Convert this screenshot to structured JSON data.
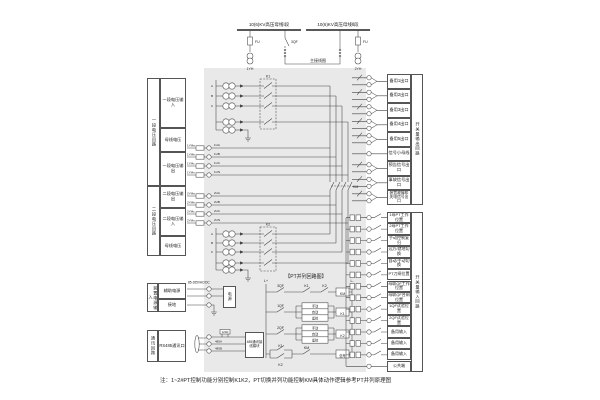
{
  "main_wiring": {
    "bus1": "10(6)KV高压母线Ⅰ段",
    "bus2": "10(6)KV高压母线Ⅱ段",
    "fu": "FU",
    "qf": "3QF",
    "pt1": "1YH",
    "pt2": "2YH",
    "caption": "主接线图"
  },
  "left": {
    "g1": {
      "v": "一段电压回路",
      "c1": "一段电压输入",
      "c2": "母线电压",
      "c3": "一段电压输出"
    },
    "g2": {
      "v": "二段电压回路",
      "c1": "二段电压输出",
      "c2": "二段电压输入",
      "c3": "母线电压"
    },
    "g3": {
      "v": "装置电源输入",
      "c1": "辅助电源",
      "c2": "接地"
    },
    "g4": {
      "v": "通讯回路",
      "c1": "RS485通讯口"
    }
  },
  "mid": {
    "title": "【PT并列回路图】",
    "k1": "K1",
    "k2": "K2",
    "km": "KM",
    "phases": [
      "A",
      "B",
      "C"
    ],
    "s1tags": [
      "1YMa",
      "1YMb",
      "1YMc",
      "1YMn"
    ],
    "s1terms": [
      "1UA",
      "1UB",
      "1UC",
      "1UN"
    ],
    "s2tags": [
      "2YMa",
      "2YMb",
      "2YMc",
      "2YMn"
    ],
    "s2terms": [
      "2UA",
      "2UB",
      "2UC",
      "2UN"
    ],
    "power": {
      "range": "85-265VAC/DC",
      "box": "电源"
    },
    "comm": {
      "box": "485通讯接线模块",
      "a": "485A",
      "b": "485B",
      "res": "120Ω"
    },
    "ladder": {
      "lp": "L+",
      "lm": "L-",
      "r1": {
        "a": "3QF",
        "b": "K1",
        "c": "K2",
        "coil": "KM"
      },
      "r2": {
        "a": "1QF",
        "s1": "手动",
        "s2": "自动",
        "s3": "遥控",
        "coil": "K1"
      },
      "r3": {
        "a": "2QF",
        "s1": "手动",
        "s2": "自动",
        "s3": "遥控",
        "coil": "K2"
      },
      "r4": {
        "a": "K1",
        "b": "K2",
        "c": "KM",
        "coil": "信号"
      }
    }
  },
  "outputs": {
    "v": "开关量输出回路",
    "items": [
      "备用1出口",
      "备用2出口",
      "备用3出口",
      "备用4出口",
      "备用5出口",
      "信号小母线",
      "预告信号出口",
      "事故信号出口",
      "装置故障和失电信号出口"
    ]
  },
  "inputs": {
    "v": "开关量输入回路",
    "items": [
      "1母PT工作位置",
      "2母PT工作位置",
      "手动控制复归",
      "远方/就地切换",
      "自动/手动切换",
      "PT刀闸位置",
      "母联QF工作位置",
      "母联QF合闸位置",
      "1QF试验位置",
      "2QF试验位置",
      "备用输入",
      "备用输入",
      "备用输入",
      "公共端"
    ]
  },
  "note": "注：1~2#PT控制功能分别控制K1K2，PT切换并列功能控制KM具体动作逻辑参考PT并列原理图"
}
